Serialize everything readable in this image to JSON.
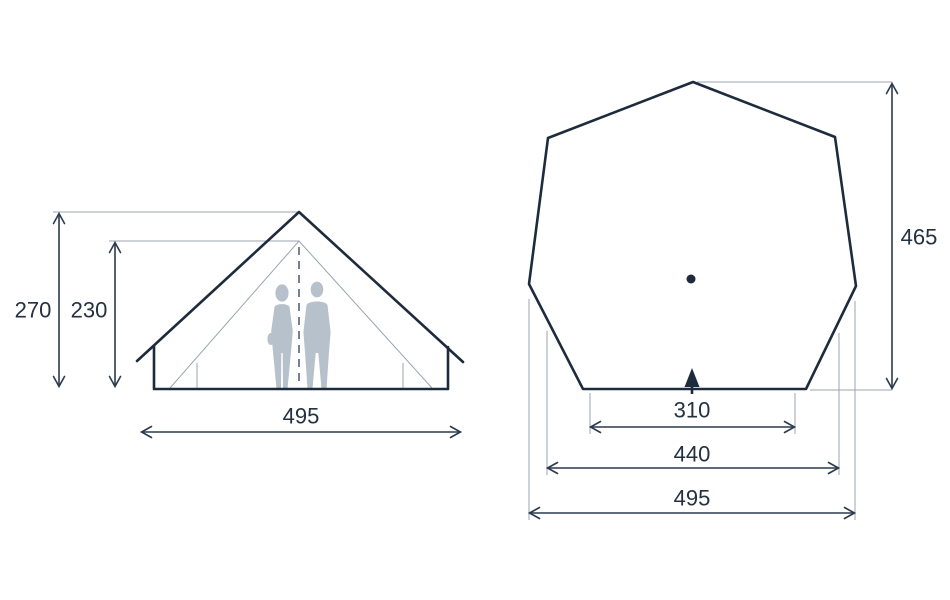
{
  "front_view": {
    "height_total": "270",
    "height_inner": "230",
    "width_base": "495"
  },
  "floor_plan": {
    "depth": "465",
    "width_door": "310",
    "width_mid": "440",
    "width_max": "495"
  },
  "colors": {
    "outline": "#1d2b3d",
    "dimension_line": "#2c3a4d",
    "extension_line": "#9aa4af",
    "silhouette": "#b7c1cb",
    "text": "#233140",
    "background": "#ffffff"
  }
}
